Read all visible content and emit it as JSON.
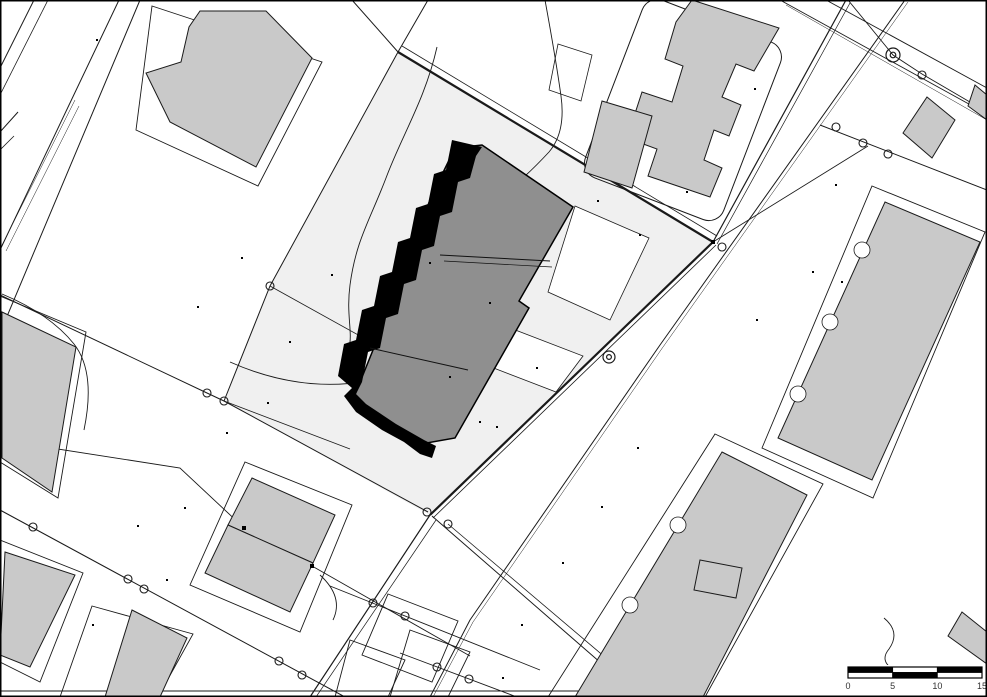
{
  "map": {
    "kind": "cadastral-site-plan",
    "canvas": {
      "width": 987,
      "height": 697,
      "background": "#ffffff",
      "frame_color": "#000000"
    },
    "colors": {
      "site_parcel": "#f0f0f0",
      "building_fill": "#c9c9c9",
      "highlight_building_fill": "#8f8f8f",
      "highlight_edge": "#000000",
      "line": "#1a1a1a",
      "white": "#ffffff"
    },
    "scale_bar": {
      "x": 848,
      "y": 667,
      "width": 134,
      "height": 11,
      "labels": [
        "0",
        "5",
        "10",
        "15"
      ],
      "top_segments": [
        "#000000",
        "#ffffff",
        "#000000"
      ],
      "bottom_segments": [
        "#ffffff",
        "#000000",
        "#ffffff"
      ]
    },
    "groups": [
      {
        "name": "site-parcel",
        "type": "polygon",
        "style": {
          "fill": "#f0f0f0",
          "stroke": "none",
          "width": 0
        },
        "items": [
          {
            "points": "398,52 713,242 430,515 224,401 270,286"
          }
        ]
      },
      {
        "name": "white-cutout",
        "type": "polygon",
        "style": {
          "fill": "#ffffff",
          "stroke": "#1a1a1a",
          "width": 0.8
        },
        "items": [
          {
            "points": "575,206 649,238 610,320 548,292"
          },
          {
            "points": "505,326 583,356 556,392 478,362"
          },
          {
            "points": "558,44 592,55 581,101 549,90"
          }
        ]
      },
      {
        "name": "plot-outline",
        "type": "polygon",
        "style": {
          "fill": "none",
          "stroke": "#1a1a1a",
          "width": 0.9
        },
        "items": [
          {
            "points": "152,6 322,62 258,186 136,130"
          },
          {
            "points": "872,186 985,232 873,498 762,448"
          },
          {
            "points": "715,434 823,484 705,697 548,697"
          },
          {
            "points": "245,462 352,505 300,632 190,585"
          },
          {
            "points": "92,606 193,634 158,697 60,697"
          },
          {
            "points": "0,540 83,573 40,682 0,662"
          },
          {
            "points": "0,296 86,332 58,498 0,462"
          },
          {
            "points": "388,594 458,621 432,682 362,655"
          },
          {
            "points": "410,630 470,652 448,697 390,697"
          },
          {
            "points": "350,640 405,660 388,697 335,697"
          }
        ]
      },
      {
        "name": "rounded-plot-outline",
        "type": "rrect",
        "style": {
          "fill": "none",
          "stroke": "#1a1a1a",
          "width": 1
        },
        "items": [
          {
            "cx": 683,
            "cy": 110,
            "w": 148,
            "h": 190,
            "rx": 16,
            "rotate": 21
          }
        ]
      },
      {
        "name": "boundary-line",
        "type": "polyline",
        "style": {
          "stroke": "#1a1a1a"
        },
        "items": [
          {
            "points": "398,52 713,242",
            "width": 2.2
          },
          {
            "points": "402,46 717,236",
            "width": 0.8
          },
          {
            "points": "713,242 430,515",
            "width": 2.2
          },
          {
            "points": "716,245 433,518",
            "width": 0.8
          },
          {
            "points": "430,515 310,697",
            "width": 1.2
          },
          {
            "points": "436,520 316,697",
            "width": 0.7
          },
          {
            "points": "398,52 270,286 224,401",
            "width": 1
          },
          {
            "points": "0,295 207,393 224,401 428,512",
            "width": 1
          },
          {
            "points": "846,0 713,242",
            "width": 1.2
          },
          {
            "points": "850,3 717,244",
            "width": 0.7
          },
          {
            "points": "905,0 660,345 470,620 430,697",
            "width": 1
          },
          {
            "points": "908,2 663,347 473,622 433,697",
            "width": 0.5
          },
          {
            "points": "432,516 640,697",
            "width": 1
          },
          {
            "points": "448,524 652,697",
            "width": 0.8
          },
          {
            "points": "0,510 345,697",
            "width": 1
          },
          {
            "points": "0,440 180,468 243,527 312,566 470,656",
            "width": 0.9
          },
          {
            "points": "330,586 540,670",
            "width": 0.9
          },
          {
            "points": "400,653 517,697",
            "width": 0.9
          },
          {
            "points": "119,0 0,250",
            "width": 1
          },
          {
            "points": "140,0 0,333",
            "width": 1
          },
          {
            "points": "75,100 2,245",
            "width": 0.5
          },
          {
            "points": "79,106 6,251",
            "width": 0.5
          },
          {
            "points": "0,132 18,112",
            "width": 1
          },
          {
            "points": "0,150 14,136",
            "width": 0.8
          },
          {
            "points": "34,0 0,68",
            "width": 1
          },
          {
            "points": "48,0 0,95",
            "width": 0.8
          },
          {
            "points": "780,0 987,114",
            "width": 0.9
          },
          {
            "points": "786,5 987,120",
            "width": 0.5
          },
          {
            "points": "826,0 987,88",
            "width": 0.9
          },
          {
            "points": "820,125 987,190",
            "width": 1
          },
          {
            "points": "713,242 868,146",
            "width": 0.9
          },
          {
            "points": "848,0 893,55 922,74 987,112",
            "width": 0.9
          },
          {
            "points": "398,52 428,0",
            "width": 1
          },
          {
            "points": "398,52 352,0",
            "width": 1
          },
          {
            "points": "270,286 443,382",
            "width": 0.8
          },
          {
            "points": "224,401 350,449",
            "width": 0.8
          },
          {
            "points": "0,691 705,691",
            "width": 1
          }
        ]
      },
      {
        "name": "contour-curve",
        "type": "path",
        "style": {
          "stroke": "#1a1a1a",
          "width": 0.9,
          "fill": "none"
        },
        "items": [
          {
            "d": "M437,47 C425,100 402,135 386,178 C370,220 356,240 350,285 C346,315 353,332 349,348"
          },
          {
            "d": "M230,362 Q300,393 368,381 Q402,374 420,394"
          },
          {
            "d": "M2,294 Q50,314 74,344 Q96,372 84,430"
          },
          {
            "d": "M545,0 Q556,60 561,96 Q566,132 549,152 Q536,166 525,176"
          },
          {
            "d": "M884,618 Q901,632 889,649 Q879,661 894,670"
          },
          {
            "d": "M320,575 Q344,597 333,620"
          }
        ]
      },
      {
        "name": "building",
        "type": "polygon",
        "style": {
          "fill": "#c9c9c9",
          "stroke": "#1a1a1a",
          "width": 1
        },
        "items": [
          {
            "points": "200,11 266,11 312,58 256,167 170,122 146,73 181,62 189,27"
          },
          {
            "points": "692,0 779,28 754,71 736,64 722,97 741,105 729,136 714,130 704,160 722,168 710,197 648,176 657,149 627,138 642,92 672,102 683,66 665,59 676,22"
          },
          {
            "points": "602,101 652,116 632,188 584,172"
          },
          {
            "points": "927,97 955,120 932,158 903,133"
          },
          {
            "points": "975,85 987,95 987,120 968,106"
          },
          {
            "points": "885,202 980,242 872,480 778,438"
          },
          {
            "points": "722,452 807,495 703,697 575,697"
          },
          {
            "points": "700,560 742,568 736,598 694,590"
          },
          {
            "points": "962,612 987,632 987,664 948,636"
          },
          {
            "points": "2,312 76,347 52,492 2,458"
          },
          {
            "points": "5,552 75,575 30,667 0,655"
          },
          {
            "points": "132,610 187,638 160,697 105,697"
          },
          {
            "points": "252,478 335,515 313,563 228,525"
          },
          {
            "points": "228,525 313,563 290,612 205,573"
          }
        ]
      },
      {
        "name": "facade-notch",
        "type": "circle",
        "style": {
          "fill": "#ffffff",
          "stroke": "#1a1a1a",
          "width": 0.8
        },
        "items": [
          {
            "cx": 798,
            "cy": 394,
            "r": 8
          },
          {
            "cx": 830,
            "cy": 322,
            "r": 8
          },
          {
            "cx": 862,
            "cy": 250,
            "r": 8
          },
          {
            "cx": 678,
            "cy": 525,
            "r": 8
          },
          {
            "cx": 630,
            "cy": 605,
            "r": 8
          }
        ]
      },
      {
        "name": "highlight-building",
        "type": "polygon",
        "style": {
          "fill": "#8f8f8f",
          "stroke": "#000000",
          "width": 1.5
        },
        "items": [
          {
            "points": "482,145 573,207 519,301 529,308 455,438 421,444 352,402 373,350 390,300 412,245 432,195 455,148"
          }
        ]
      },
      {
        "name": "highlight-stepped-edge",
        "type": "path",
        "style": {
          "fill": "#000000",
          "stroke": "none",
          "width": 0
        },
        "items": [
          {
            "d": "M482,147 L452,140 L446,170 L434,174 L428,204 L416,208 L410,238 L398,242 L392,272 L380,276 L374,306 L362,310 L356,340 L344,344 L338,376 L352,388 L344,396 L356,412 L382,430 L404,442 L420,454 L432,458 L436,446 L424,440 L396,424 L366,404 L356,394 L362,382 L368,352 L380,348 L386,318 L398,314 L404,284 L416,280 L422,250 L434,246 L440,216 L452,212 L458,182 L470,178 L476,156 Z"
          }
        ]
      },
      {
        "name": "division-line",
        "type": "polyline",
        "style": {
          "stroke": "#111111"
        },
        "items": [
          {
            "points": "440,255 550,261",
            "width": 1
          },
          {
            "points": "444,261 552,267",
            "width": 0.7
          },
          {
            "points": "370,348 468,370",
            "width": 1
          }
        ]
      },
      {
        "name": "survey-circle",
        "type": "circle",
        "style": {
          "fill": "none",
          "stroke": "#1a1a1a",
          "width": 1.1
        },
        "items": [
          {
            "cx": 270,
            "cy": 286,
            "r": 4
          },
          {
            "cx": 207,
            "cy": 393,
            "r": 4
          },
          {
            "cx": 224,
            "cy": 401,
            "r": 4
          },
          {
            "cx": 427,
            "cy": 512,
            "r": 4
          },
          {
            "cx": 448,
            "cy": 524,
            "r": 4
          },
          {
            "cx": 722,
            "cy": 247,
            "r": 4
          },
          {
            "cx": 836,
            "cy": 127,
            "r": 4
          },
          {
            "cx": 863,
            "cy": 143,
            "r": 4
          },
          {
            "cx": 888,
            "cy": 154,
            "r": 4
          },
          {
            "cx": 922,
            "cy": 75,
            "r": 4
          },
          {
            "cx": 128,
            "cy": 579,
            "r": 4
          },
          {
            "cx": 144,
            "cy": 589,
            "r": 4
          },
          {
            "cx": 33,
            "cy": 527,
            "r": 4
          },
          {
            "cx": 279,
            "cy": 661,
            "r": 4
          },
          {
            "cx": 302,
            "cy": 675,
            "r": 4
          },
          {
            "cx": 373,
            "cy": 603,
            "r": 4
          },
          {
            "cx": 405,
            "cy": 616,
            "r": 4
          },
          {
            "cx": 437,
            "cy": 667,
            "r": 4
          },
          {
            "cx": 469,
            "cy": 679,
            "r": 4
          }
        ]
      },
      {
        "name": "survey-double-circle",
        "type": "double-circle",
        "style": {
          "fill": "none",
          "stroke": "#1a1a1a",
          "width": 1.2
        },
        "items": [
          {
            "cx": 609,
            "cy": 357,
            "r": 6
          },
          {
            "cx": 893,
            "cy": 55,
            "r": 7
          }
        ]
      },
      {
        "name": "marker-square",
        "type": "dot",
        "style": {
          "fill": "#000000"
        },
        "items": [
          {
            "x": 713,
            "y": 242,
            "s": 4
          },
          {
            "x": 244,
            "y": 528,
            "s": 4
          },
          {
            "x": 312,
            "y": 566,
            "s": 4
          }
        ]
      },
      {
        "name": "point-dot",
        "type": "dot",
        "style": {
          "fill": "#000000"
        },
        "items": [
          {
            "x": 97,
            "y": 40,
            "s": 2
          },
          {
            "x": 242,
            "y": 258,
            "s": 2
          },
          {
            "x": 332,
            "y": 275,
            "s": 2
          },
          {
            "x": 198,
            "y": 307,
            "s": 2
          },
          {
            "x": 290,
            "y": 342,
            "s": 2
          },
          {
            "x": 268,
            "y": 403,
            "s": 2
          },
          {
            "x": 227,
            "y": 433,
            "s": 2
          },
          {
            "x": 185,
            "y": 508,
            "s": 2
          },
          {
            "x": 138,
            "y": 526,
            "s": 2
          },
          {
            "x": 93,
            "y": 625,
            "s": 2
          },
          {
            "x": 167,
            "y": 580,
            "s": 2
          },
          {
            "x": 450,
            "y": 377,
            "s": 2
          },
          {
            "x": 537,
            "y": 368,
            "s": 2
          },
          {
            "x": 480,
            "y": 422,
            "s": 2
          },
          {
            "x": 598,
            "y": 201,
            "s": 2
          },
          {
            "x": 640,
            "y": 235,
            "s": 2
          },
          {
            "x": 757,
            "y": 320,
            "s": 2
          },
          {
            "x": 813,
            "y": 272,
            "s": 2
          },
          {
            "x": 842,
            "y": 282,
            "s": 2
          },
          {
            "x": 836,
            "y": 185,
            "s": 2
          },
          {
            "x": 602,
            "y": 507,
            "s": 2
          },
          {
            "x": 522,
            "y": 625,
            "s": 2
          },
          {
            "x": 503,
            "y": 678,
            "s": 2
          },
          {
            "x": 563,
            "y": 563,
            "s": 2
          },
          {
            "x": 755,
            "y": 89,
            "s": 2
          },
          {
            "x": 687,
            "y": 192,
            "s": 2
          },
          {
            "x": 430,
            "y": 263,
            "s": 2
          },
          {
            "x": 490,
            "y": 303,
            "s": 2
          },
          {
            "x": 497,
            "y": 427,
            "s": 2
          },
          {
            "x": 638,
            "y": 448,
            "s": 2
          }
        ]
      }
    ]
  }
}
